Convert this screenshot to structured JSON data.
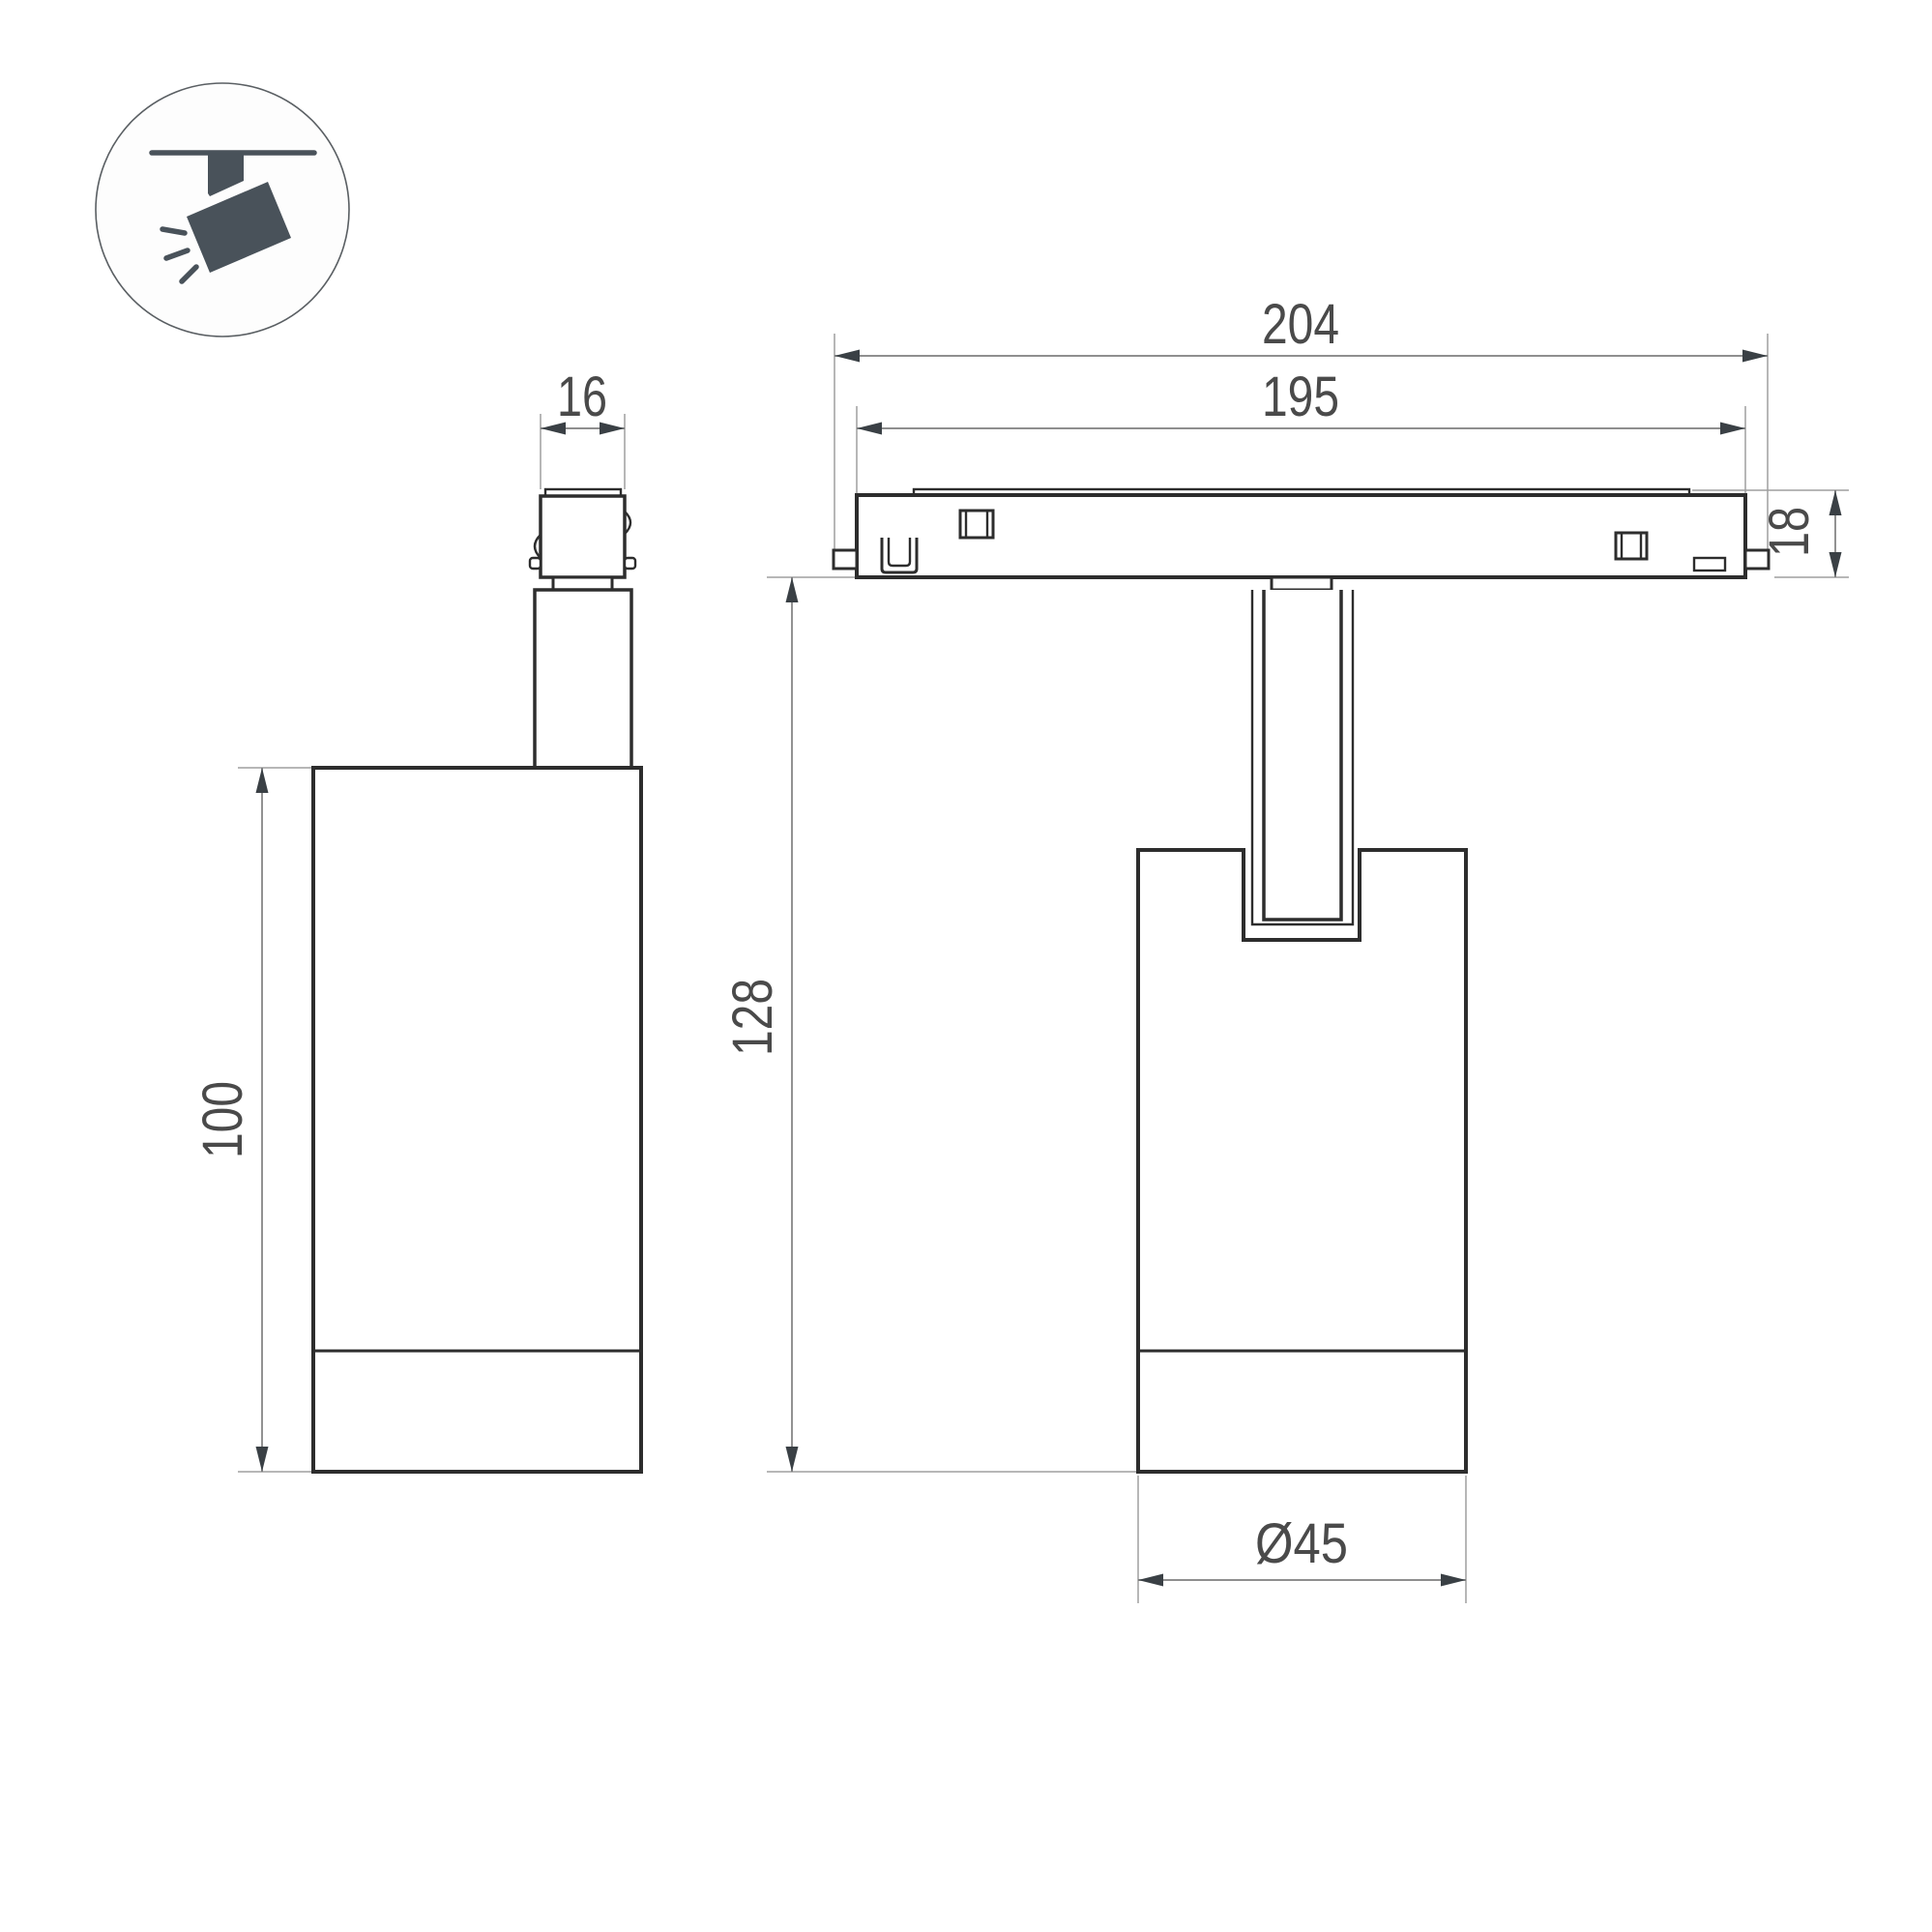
{
  "drawing": {
    "kind": "technical dimension drawing",
    "subject": "magnetic track spotlight, two orthographic views with ceiling-spot pictogram"
  },
  "icon": {
    "name": "ceiling-track-spotlight-icon"
  },
  "dims": {
    "track_outer_length": "204",
    "track_inner_length": "195",
    "adapter_width": "16",
    "track_height": "18",
    "body_height": "100",
    "overall_height": "128",
    "body_diameter": "Ø45"
  },
  "colors": {
    "outline": "#2d2d2d",
    "dimension_line": "#7f7f7f",
    "extension_line": "#9f9f9f",
    "arrowhead": "#3a4045",
    "dimension_text": "#4a4a4a",
    "icon": "#49525a",
    "background": "#ffffff"
  }
}
